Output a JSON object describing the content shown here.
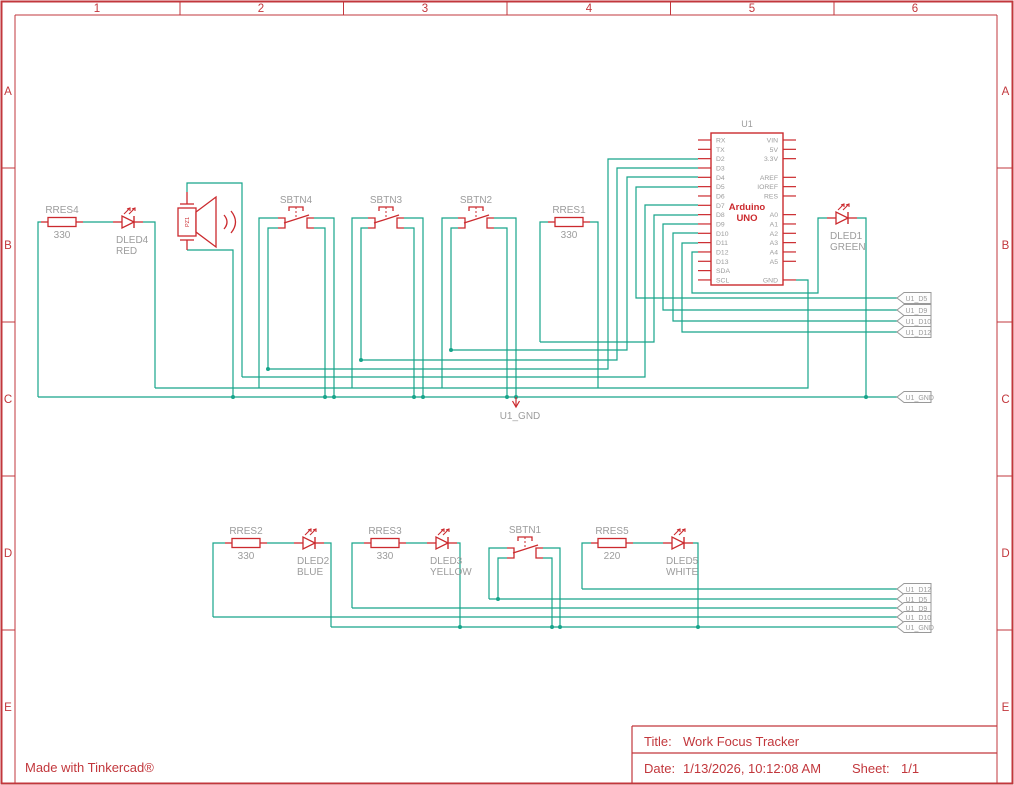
{
  "colors": {
    "frame_red": "#c2373c",
    "comp_red": "#cb2a2e",
    "wire_green": "#17a58b",
    "label_gray": "#9c9c9c",
    "flag_gray": "#999999"
  },
  "frame": {
    "col_labels": [
      "1",
      "2",
      "3",
      "4",
      "5",
      "6"
    ],
    "row_labels": [
      "A",
      "B",
      "C",
      "D",
      "E"
    ],
    "col_centers": [
      97,
      261,
      425,
      589,
      752,
      915
    ],
    "col_ticks": [
      180,
      343.5,
      507,
      670.5,
      834
    ],
    "row_centers": [
      91,
      245,
      399,
      553,
      707
    ],
    "row_ticks": [
      168,
      322,
      476,
      630
    ]
  },
  "title_block": {
    "title_label": "Title:",
    "title": "Work Focus Tracker",
    "date_label": "Date:",
    "date": "1/13/2026, 10:12:08 AM",
    "sheet_label": "Sheet:",
    "sheet": "1/1"
  },
  "footer": {
    "credit": "Made with Tinkercad®"
  },
  "arduino": {
    "ref": "U1",
    "name_line1": "Arduino",
    "name_line2": "UNO",
    "box": [
      711,
      133,
      783,
      285
    ],
    "left_pins": [
      "RX",
      "TX",
      "D2",
      "D3",
      "D4",
      "D5",
      "D6",
      "D7",
      "D8",
      "D9",
      "D10",
      "D11",
      "D12",
      "D13",
      "SDA",
      "SCL"
    ],
    "right_pins": [
      "VIN",
      "5V",
      "3.3V",
      "",
      "AREF",
      "IOREF",
      "RES",
      "",
      "A0",
      "A1",
      "A2",
      "A3",
      "A4",
      "A5",
      "",
      "GND"
    ],
    "pin_y0": 140,
    "pin_dy": 9.33
  },
  "resistors": [
    {
      "name": "RRES4",
      "value": "330",
      "x": 48,
      "y": 222
    },
    {
      "name": "RRES1",
      "value": "330",
      "x": 555,
      "y": 222
    },
    {
      "name": "RRES2",
      "value": "330",
      "x": 232,
      "y": 543
    },
    {
      "name": "RRES3",
      "value": "330",
      "x": 371,
      "y": 543
    },
    {
      "name": "RRES5",
      "value": "220",
      "x": 598,
      "y": 543
    }
  ],
  "leds": [
    {
      "name": "DLED4",
      "color_label": "RED",
      "x": 122,
      "y": 222
    },
    {
      "name": "DLED1",
      "color_label": "GREEN",
      "x": 836,
      "y": 218
    },
    {
      "name": "DLED2",
      "color_label": "BLUE",
      "x": 303,
      "y": 543
    },
    {
      "name": "DLED3",
      "color_label": "YELLOW",
      "x": 436,
      "y": 543
    },
    {
      "name": "DLED5",
      "color_label": "WHITE",
      "x": 672,
      "y": 543
    }
  ],
  "buttons": [
    {
      "name": "SBTN4",
      "cx": 296,
      "cy": 222
    },
    {
      "name": "SBTN3",
      "cx": 386,
      "cy": 222
    },
    {
      "name": "SBTN2",
      "cx": 476,
      "cy": 222
    },
    {
      "name": "SBTN1",
      "cx": 525,
      "cy": 552
    }
  ],
  "piezo": {
    "name": "PZ1",
    "cx": 187,
    "cy": 222
  },
  "net_flags": [
    {
      "label": "U1_D5",
      "x": 897,
      "y": 298
    },
    {
      "label": "U1_D9",
      "x": 897,
      "y": 310
    },
    {
      "label": "U1_D10",
      "x": 897,
      "y": 321
    },
    {
      "label": "U1_D12",
      "x": 897,
      "y": 332
    },
    {
      "label": "U1_GND",
      "x": 897,
      "y": 397
    },
    {
      "label": "U1_D12",
      "x": 897,
      "y": 589
    },
    {
      "label": "U1_D5",
      "x": 897,
      "y": 599
    },
    {
      "label": "U1_D9",
      "x": 897,
      "y": 608
    },
    {
      "label": "U1_D10",
      "x": 897,
      "y": 617
    },
    {
      "label": "U1_GND",
      "x": 897,
      "y": 627
    }
  ],
  "gnd_marker": {
    "label": "U1_GND",
    "x": 516,
    "y": 397
  },
  "wires": [
    [
      [
        41,
        222
      ],
      [
        38,
        222
      ],
      [
        38,
        397
      ]
    ],
    [
      [
        38,
        397
      ],
      [
        897,
        397
      ]
    ],
    [
      [
        83,
        222
      ],
      [
        113,
        222
      ]
    ],
    [
      [
        143,
        222
      ],
      [
        155,
        222
      ],
      [
        155,
        388
      ]
    ],
    [
      [
        155,
        388
      ],
      [
        808,
        388
      ],
      [
        808,
        280
      ],
      [
        796,
        280
      ]
    ],
    [
      [
        187,
        192
      ],
      [
        187,
        183
      ],
      [
        242,
        183
      ],
      [
        242,
        377
      ]
    ],
    [
      [
        242,
        377
      ],
      [
        645,
        377
      ],
      [
        645,
        205
      ],
      [
        698,
        205
      ]
    ],
    [
      [
        187,
        250
      ],
      [
        233,
        250
      ],
      [
        233,
        397
      ]
    ],
    [
      [
        278,
        218
      ],
      [
        259,
        218
      ],
      [
        259,
        388
      ]
    ],
    [
      [
        278,
        228
      ],
      [
        268,
        228
      ],
      [
        268,
        369
      ]
    ],
    [
      [
        268,
        369
      ],
      [
        608,
        369
      ],
      [
        608,
        159
      ],
      [
        698,
        159
      ]
    ],
    [
      [
        314,
        228
      ],
      [
        325,
        228
      ],
      [
        325,
        397
      ]
    ],
    [
      [
        314,
        218
      ],
      [
        334,
        218
      ],
      [
        334,
        397
      ]
    ],
    [
      [
        368,
        218
      ],
      [
        352,
        218
      ],
      [
        352,
        388
      ]
    ],
    [
      [
        368,
        228
      ],
      [
        361,
        228
      ],
      [
        361,
        360
      ]
    ],
    [
      [
        361,
        360
      ],
      [
        617,
        360
      ],
      [
        617,
        168
      ],
      [
        698,
        168
      ]
    ],
    [
      [
        404,
        228
      ],
      [
        414,
        228
      ],
      [
        414,
        397
      ]
    ],
    [
      [
        404,
        218
      ],
      [
        423,
        218
      ],
      [
        423,
        397
      ]
    ],
    [
      [
        458,
        218
      ],
      [
        442,
        218
      ],
      [
        442,
        388
      ]
    ],
    [
      [
        458,
        228
      ],
      [
        451,
        228
      ],
      [
        451,
        350
      ]
    ],
    [
      [
        451,
        350
      ],
      [
        627,
        350
      ],
      [
        627,
        177
      ],
      [
        698,
        177
      ]
    ],
    [
      [
        494,
        228
      ],
      [
        507,
        228
      ],
      [
        507,
        397
      ]
    ],
    [
      [
        494,
        218
      ],
      [
        516,
        218
      ],
      [
        516,
        397
      ]
    ],
    [
      [
        548,
        222
      ],
      [
        540,
        222
      ],
      [
        540,
        342
      ]
    ],
    [
      [
        540,
        342
      ],
      [
        654,
        342
      ],
      [
        654,
        215
      ],
      [
        698,
        215
      ]
    ],
    [
      [
        590,
        222
      ],
      [
        598,
        222
      ],
      [
        598,
        388
      ]
    ],
    [
      [
        698,
        187
      ],
      [
        636,
        187
      ],
      [
        636,
        298
      ],
      [
        897,
        298
      ]
    ],
    [
      [
        698,
        224
      ],
      [
        663,
        224
      ],
      [
        663,
        310
      ],
      [
        897,
        310
      ]
    ],
    [
      [
        698,
        233
      ],
      [
        673,
        233
      ],
      [
        673,
        321
      ],
      [
        897,
        321
      ]
    ],
    [
      [
        698,
        243
      ],
      [
        682,
        243
      ],
      [
        682,
        332
      ],
      [
        897,
        332
      ]
    ],
    [
      [
        698,
        252
      ],
      [
        692,
        252
      ],
      [
        692,
        293
      ],
      [
        818,
        293
      ],
      [
        818,
        218
      ],
      [
        827,
        218
      ]
    ],
    [
      [
        857,
        218
      ],
      [
        866,
        218
      ],
      [
        866,
        397
      ]
    ],
    [
      [
        225,
        543
      ],
      [
        213,
        543
      ],
      [
        213,
        617
      ]
    ],
    [
      [
        213,
        617
      ],
      [
        897,
        617
      ]
    ],
    [
      [
        267,
        543
      ],
      [
        294,
        543
      ]
    ],
    [
      [
        324,
        543
      ],
      [
        331,
        543
      ],
      [
        331,
        627
      ]
    ],
    [
      [
        331,
        627
      ],
      [
        897,
        627
      ]
    ],
    [
      [
        364,
        543
      ],
      [
        352,
        543
      ],
      [
        352,
        608
      ]
    ],
    [
      [
        352,
        608
      ],
      [
        897,
        608
      ]
    ],
    [
      [
        406,
        543
      ],
      [
        427,
        543
      ]
    ],
    [
      [
        457,
        543
      ],
      [
        460,
        543
      ],
      [
        460,
        627
      ]
    ],
    [
      [
        507,
        548
      ],
      [
        489,
        548
      ],
      [
        489,
        599
      ]
    ],
    [
      [
        489,
        599
      ],
      [
        897,
        599
      ]
    ],
    [
      [
        507,
        558
      ],
      [
        498,
        558
      ],
      [
        498,
        599
      ]
    ],
    [
      [
        543,
        558
      ],
      [
        552,
        558
      ],
      [
        552,
        627
      ]
    ],
    [
      [
        543,
        548
      ],
      [
        560,
        548
      ],
      [
        560,
        627
      ]
    ],
    [
      [
        591,
        543
      ],
      [
        582,
        543
      ],
      [
        582,
        589
      ]
    ],
    [
      [
        582,
        589
      ],
      [
        897,
        589
      ]
    ],
    [
      [
        633,
        543
      ],
      [
        663,
        543
      ]
    ],
    [
      [
        693,
        543
      ],
      [
        698,
        543
      ],
      [
        698,
        627
      ]
    ]
  ],
  "junctions": [
    [
      233,
      397
    ],
    [
      268,
      369
    ],
    [
      325,
      397
    ],
    [
      334,
      397
    ],
    [
      361,
      360
    ],
    [
      414,
      397
    ],
    [
      423,
      397
    ],
    [
      451,
      350
    ],
    [
      507,
      397
    ],
    [
      516,
      397
    ],
    [
      866,
      397
    ],
    [
      460,
      627
    ],
    [
      498,
      599
    ],
    [
      552,
      627
    ],
    [
      560,
      627
    ],
    [
      698,
      627
    ]
  ]
}
